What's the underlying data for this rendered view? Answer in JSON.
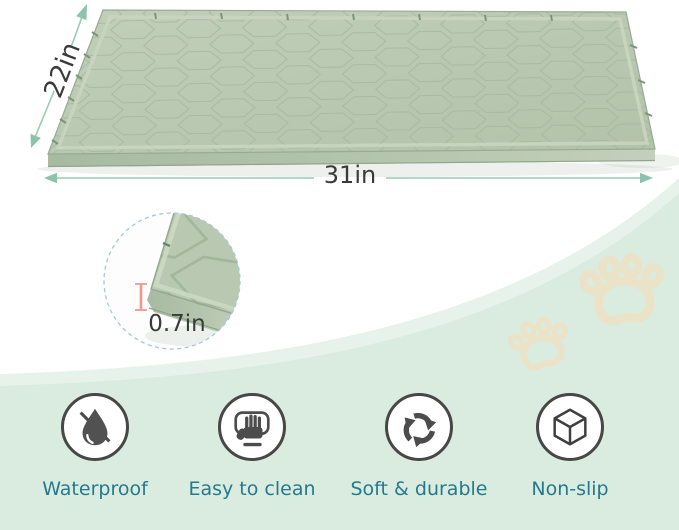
{
  "product_view": {
    "name": "silicone pet feeding mat",
    "depth_label": "22in",
    "width_label": "31in",
    "thickness_label": "0.7in"
  },
  "features": [
    {
      "label": "Waterproof",
      "icon": "waterproof-icon"
    },
    {
      "label": "Easy to clean",
      "icon": "easy-clean-icon"
    },
    {
      "label": "Soft & durable",
      "icon": "soft-durable-icon"
    },
    {
      "label": "Non-slip",
      "icon": "non-slip-icon"
    }
  ],
  "colors": {
    "mat_surface": "#b9c9b1",
    "arrow_accent": "#8cc3ac",
    "feature_label": "#26798c",
    "background_wave": "#d9ecdf",
    "paw_print": "#eae3c8",
    "thickness_ruler": "#ef9a8f",
    "icon_ink": "#4c4c4c"
  }
}
